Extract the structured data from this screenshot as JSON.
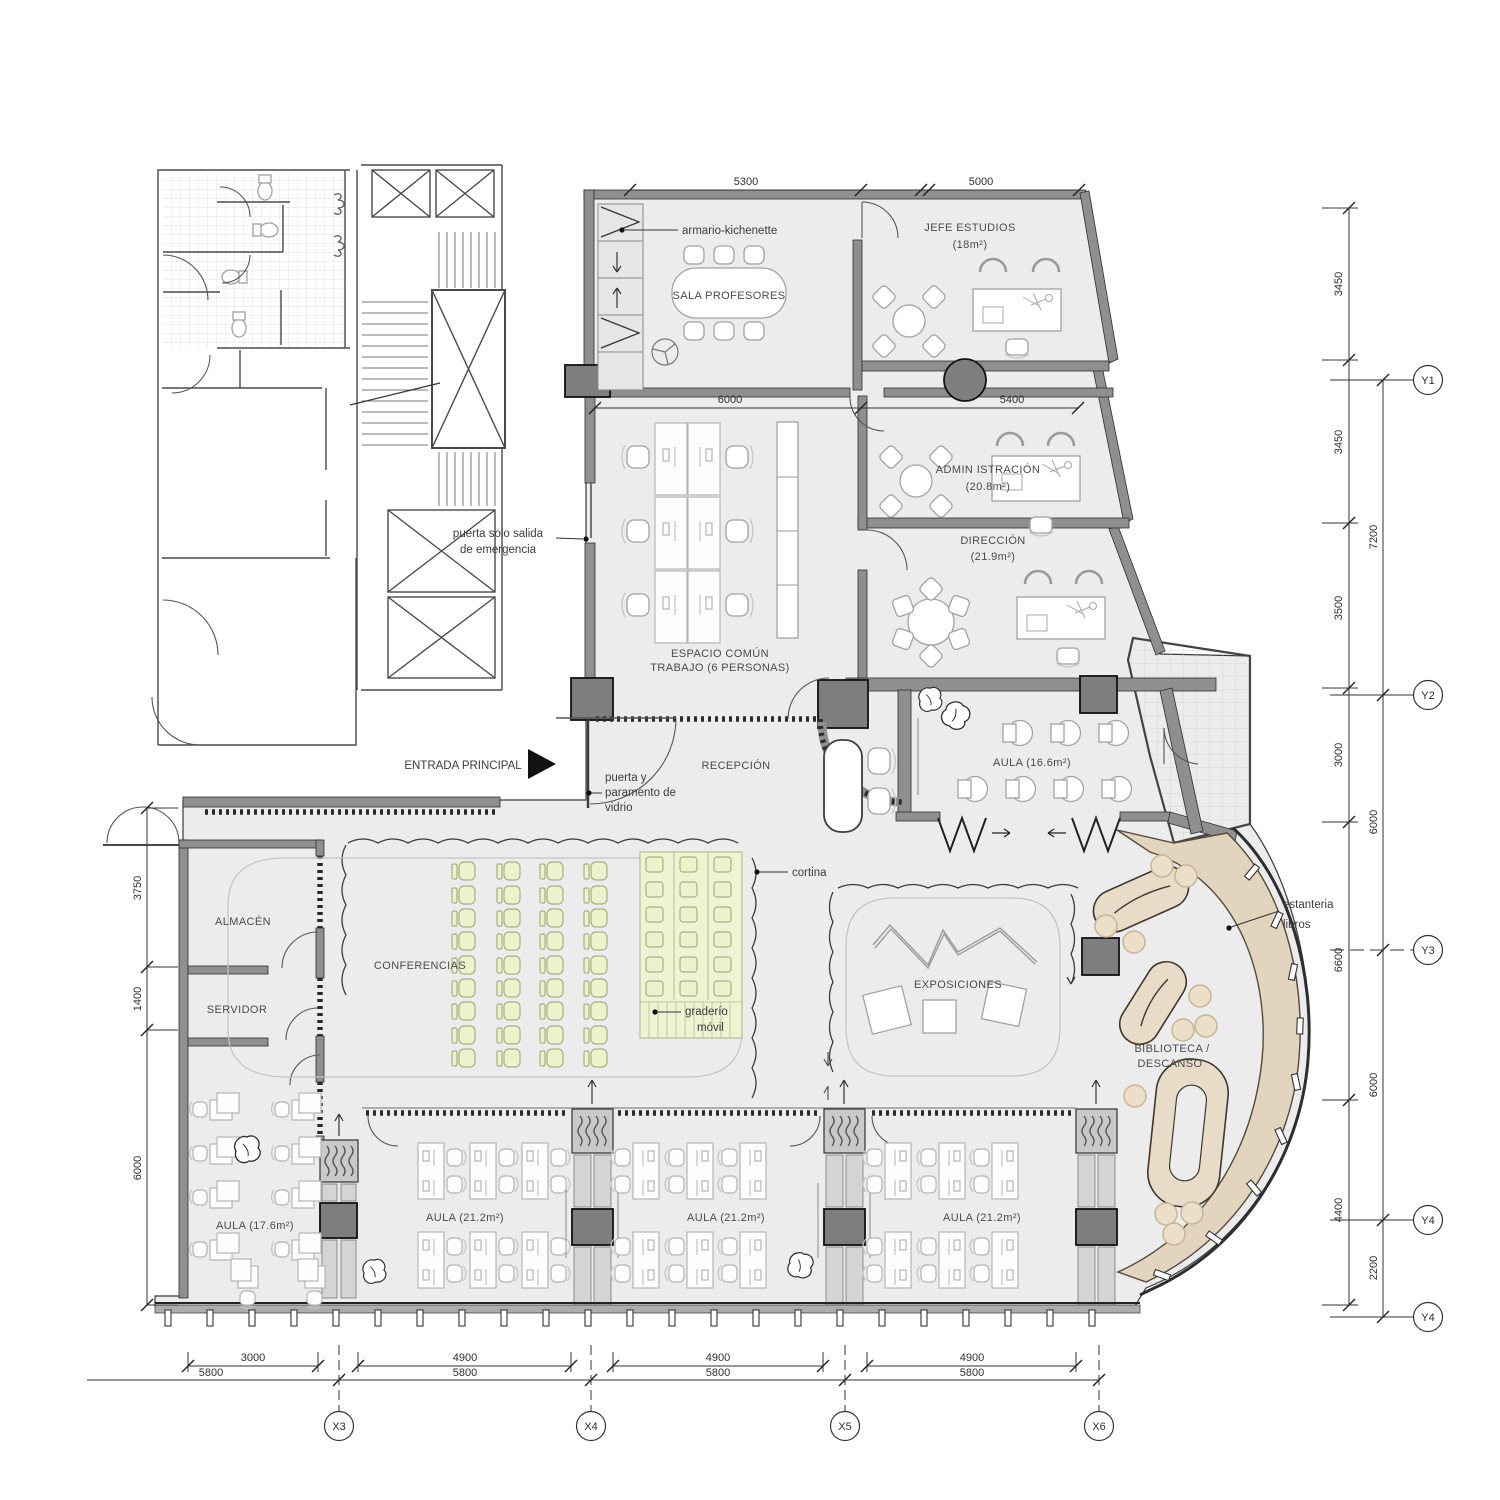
{
  "plan": {
    "rooms": {
      "sala_profesores": "SALA PROFESORES",
      "jefe_estudios": {
        "name": "JEFE ESTUDIOS",
        "area": "(18m²)"
      },
      "administracion": {
        "name": "ADMIN ISTRACIÓN",
        "area": "(20.8m²)"
      },
      "direccion": {
        "name": "DIRECCIÓN",
        "area": "(21.9m²)"
      },
      "espacio_comun": {
        "line1": "ESPACIO COMÚN",
        "line2": "TRABAJO (6 PERSONAS)"
      },
      "recepcion": "RECEPCIÓN",
      "aula_166": "AULA (16.6m²)",
      "almacen": "ALMACÉN",
      "servidor": "SERVIDOR",
      "conferencias": "CONFERENCIAS",
      "exposiciones": "EXPOSICIONES",
      "biblioteca": {
        "line1": "BIBLIOTECA /",
        "line2": "DESCANSO"
      },
      "aula_176": "AULA (17.6m²)",
      "aulas_212": [
        "AULA (21.2m²)",
        "AULA (21.2m²)",
        "AULA (21.2m²)"
      ]
    },
    "annotations": {
      "armario": "armario-kichenette",
      "salida_1": "puerta solo salida",
      "salida_2": "de emergencia",
      "entrada": "ENTRADA PRINCIPAL",
      "puerta_1": "puerta y",
      "puerta_2": "paramento de",
      "puerta_3": "vidrio",
      "cortina": "cortina",
      "graderio_1": "graderío",
      "graderio_2": "móvil",
      "estanteria_1": "estanteria",
      "estanteria_2": "libros"
    },
    "dimensions": {
      "top": [
        "5300",
        "5000"
      ],
      "mid": [
        "6000",
        "5400"
      ],
      "left": [
        "3750",
        "1400",
        "6000"
      ],
      "right_inner": [
        "3450",
        "3450",
        "3500",
        "3000",
        "6600",
        "4400"
      ],
      "right_outer": [
        "7200",
        "6000",
        "6000",
        "2200"
      ],
      "bottom_inner": [
        "3000",
        "4900",
        "4900",
        "4900"
      ],
      "bottom_outer": [
        "5800",
        "5800",
        "5800",
        "5800"
      ]
    },
    "grid": {
      "x": [
        "X3",
        "X4",
        "X5",
        "X6"
      ],
      "y": [
        "Y1",
        "Y2",
        "Y3",
        "Y4",
        "Y4"
      ]
    },
    "colors": {
      "floor": "#ececec",
      "wall": "#8f8f8f",
      "conference_seat": "#edf2cd",
      "library_band": "#e2d4bf",
      "library_seat": "#e8dcc9"
    }
  }
}
